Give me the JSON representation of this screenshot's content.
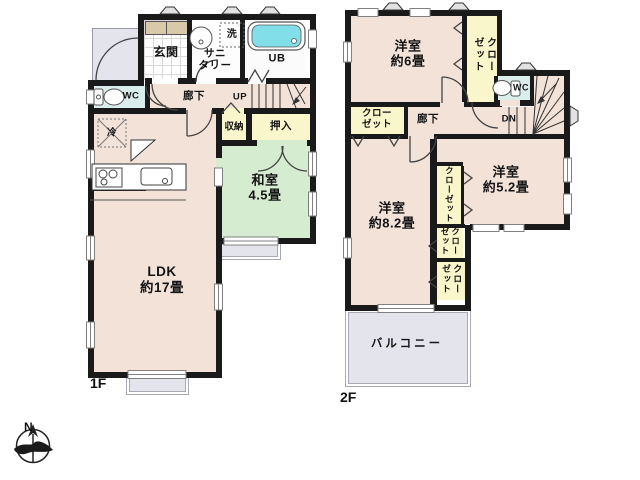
{
  "colors": {
    "wall": "#1a1a1a",
    "room": "#f2e2d8",
    "tatami": "#d5ecd0",
    "closet": "#faf6cc",
    "wet": "#d9edea",
    "outdoor": "#e4e4ed",
    "tub_water": "#82dfe9",
    "cabinet": "#d8c9a8",
    "background": "#ffffff"
  },
  "floor1": {
    "label": "1F",
    "entrance": "玄関",
    "sanitary": "サニ\nタリー",
    "laundry": "洗",
    "unit_bath": "UB",
    "toilet": "WC",
    "hallway": "廊下",
    "stairs_up": "UP",
    "storage": "収納",
    "oshiire": "押入",
    "washitsu": "和室\n4.5畳",
    "ldk": "LDK\n約17畳",
    "fridge": "冷"
  },
  "floor2": {
    "label": "2F",
    "bedroom6": "洋室\n約6畳",
    "bedroom82": "洋室\n約8.2畳",
    "bedroom52": "洋室\n約5.2畳",
    "closet": "クローゼット",
    "closet_two_line": "クロー\nゼット",
    "toilet": "WC",
    "hallway": "廊下",
    "stairs_down": "DN",
    "balcony": "バルコニー"
  },
  "compass": {
    "north": "N"
  }
}
